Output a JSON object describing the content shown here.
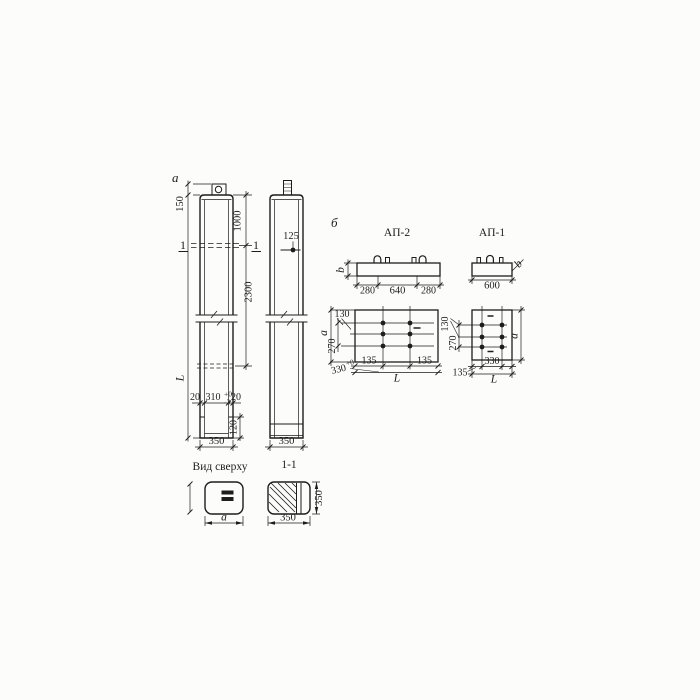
{
  "colors": {
    "ink": "#1d1d1d",
    "paper": "#fcfcfb"
  },
  "figure_labels": {
    "left": "а",
    "right": "б"
  },
  "column1": {
    "section_mark_left": "1",
    "section_mark_right": "1",
    "dim_150": "150",
    "dim_L": "L",
    "dim_1000": "1000",
    "dim_2300": "2300",
    "dim_20_left": "20",
    "dim_310": "310",
    "dim_310_tol_upper": "+0",
    "dim_310_tol_lower": "-3",
    "dim_20_right": "20",
    "dim_120": "120",
    "dim_350": "350"
  },
  "column2": {
    "dim_125": "125",
    "dim_350": "350"
  },
  "top_view": {
    "title": "Вид сверху",
    "dim_a": "а"
  },
  "section_view": {
    "title": "1-1",
    "dim_width_350": "350",
    "dim_height_350": "350"
  },
  "ap2": {
    "title": "АП-2",
    "dim_b": "b",
    "dim_280_left": "280",
    "dim_640": "640",
    "dim_280_right": "280",
    "plan": {
      "dim_130": "130",
      "dim_a": "а",
      "dim_270": "270",
      "dim_330": "330",
      "dim_330_tol": "+0",
      "dim_135_left": "135",
      "dim_135_right": "135",
      "dim_L": "L"
    }
  },
  "ap1": {
    "title": "АП-1",
    "dim_600": "600",
    "dim_b": "b",
    "plan": {
      "dim_130": "130",
      "dim_270": "270",
      "dim_a": "а",
      "dim_330": "330",
      "dim_135": "135",
      "dim_L": "L"
    }
  }
}
